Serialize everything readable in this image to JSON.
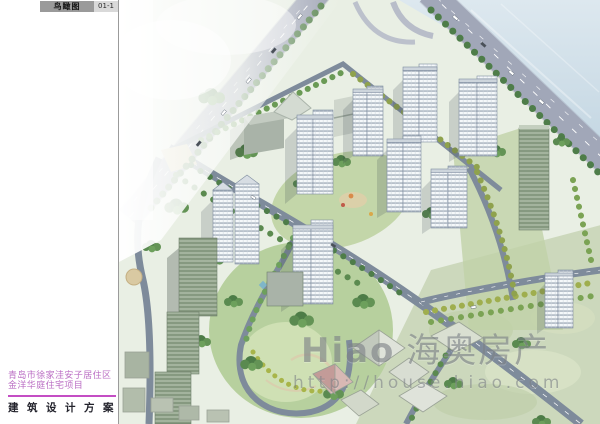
{
  "header": {
    "sheet_label": "鸟瞰图",
    "sheet_number": "01-1"
  },
  "margin": {
    "project_title_line1": "青岛市徐家洼安子居住区",
    "project_title_line2": "金洋华庭住宅项目",
    "doc_type": "建筑设计方案"
  },
  "watermark": {
    "logo_latin": "Hiao",
    "logo_cjk": "海奥房产",
    "url": "http://house.hiao.com"
  },
  "scene": {
    "description": "aerial-rendering-of-residential-district",
    "features": [
      "sea-water-top-right",
      "two-diagonal-highways",
      "white-highrise-towers",
      "green-parks-and-tree-rows",
      "village-lowrise-bottom-left",
      "pitched-roof-houses-bottom-center"
    ]
  },
  "palette": {
    "accent_purple": "#bb6fc4",
    "rule_magenta": "#c44ec4",
    "label_bar_gray": "#9a9a9a",
    "label_num_bg": "#d9d9d9",
    "watermark_gray": "#7d8287",
    "ground_green": "#e9efe4",
    "water_blue": "#cddee9",
    "road_gray": "#a9aebf",
    "tree_green": "#4e7d49",
    "tower_white": "#f5f8fa"
  }
}
